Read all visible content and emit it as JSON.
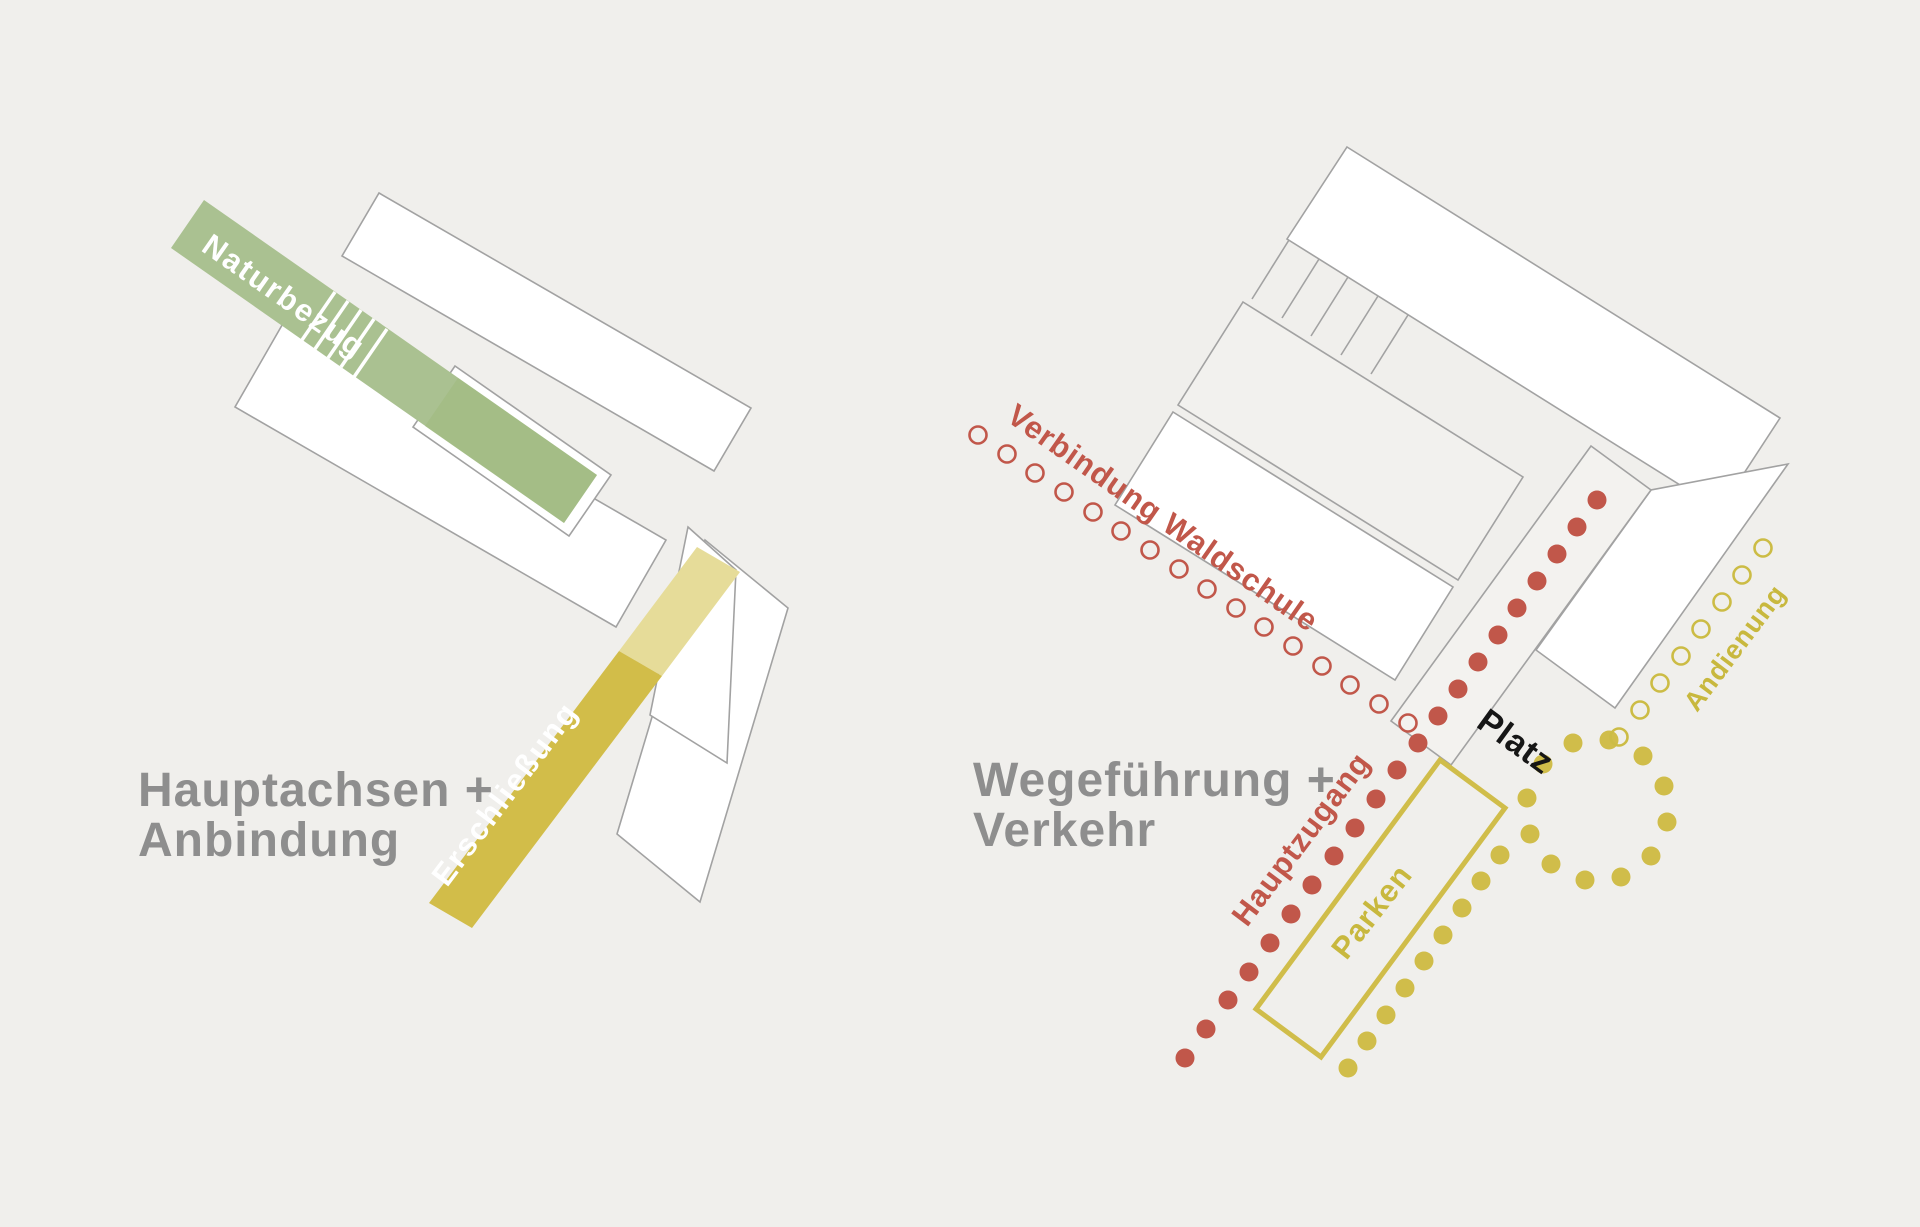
{
  "canvas": {
    "width": 1920,
    "height": 1227,
    "background": "#f0efec"
  },
  "palette": {
    "building_fill": "#ffffff",
    "building_fill_light": "#f2f1ee",
    "building_stroke": "#a2a2a2",
    "green_band": "#aac191",
    "green_band_dark": "#9fb97e",
    "yellow_band": "#d2bd49",
    "yellow_band_light": "#e6dc99",
    "red": "#c1574a",
    "yellow_dot": "#d0bd4a",
    "yellow_text": "#c8b83e",
    "title_gray": "#8e8e8e",
    "platz_black": "#161616"
  },
  "left_diagram": {
    "title_line1": "Hauptachsen +",
    "title_line2": "Anbindung",
    "green_band_label": "Naturbezug",
    "yellow_band_label": "Erschließung"
  },
  "right_diagram": {
    "title_line1": "Wegeführung +",
    "title_line2": "Verkehr",
    "label_verbindung": "Verbindung Waldschule",
    "label_platz": "Platz",
    "label_hauptzugang": "Hauptzugang",
    "label_parken": "Parken",
    "label_andienung": "Andienung"
  },
  "chains": [
    {
      "id": "red-open-waldschule",
      "style": "open",
      "color": "#c1574a",
      "r": 8.5,
      "stroke_width": 2.6,
      "points": [
        [
          978,
          435
        ],
        [
          1007,
          454
        ],
        [
          1035,
          473
        ],
        [
          1064,
          492
        ],
        [
          1093,
          512
        ],
        [
          1121,
          531
        ],
        [
          1150,
          550
        ],
        [
          1179,
          569
        ],
        [
          1207,
          589
        ],
        [
          1236,
          608
        ],
        [
          1264,
          627
        ],
        [
          1293,
          646
        ],
        [
          1322,
          666
        ],
        [
          1350,
          685
        ],
        [
          1379,
          704
        ],
        [
          1408,
          723
        ]
      ]
    },
    {
      "id": "red-filled-platz-axis",
      "style": "filled",
      "color": "#c1574a",
      "r": 9.5,
      "points": [
        [
          1597,
          500
        ],
        [
          1577,
          527
        ],
        [
          1557,
          554
        ],
        [
          1537,
          581
        ],
        [
          1517,
          608
        ],
        [
          1498,
          635
        ],
        [
          1478,
          662
        ],
        [
          1458,
          689
        ],
        [
          1438,
          716
        ],
        [
          1418,
          743
        ]
      ]
    },
    {
      "id": "red-filled-hauptzugang",
      "style": "filled",
      "color": "#c1574a",
      "r": 9.5,
      "points": [
        [
          1397,
          770
        ],
        [
          1376,
          799
        ],
        [
          1355,
          828
        ],
        [
          1334,
          856
        ],
        [
          1312,
          885
        ],
        [
          1291,
          914
        ],
        [
          1270,
          943
        ],
        [
          1249,
          972
        ],
        [
          1228,
          1000
        ],
        [
          1206,
          1029
        ],
        [
          1185,
          1058
        ]
      ]
    },
    {
      "id": "yellow-filled-parken-edge",
      "style": "filled",
      "color": "#d0bd4a",
      "r": 9.5,
      "points": [
        [
          1348,
          1068
        ],
        [
          1367,
          1041
        ],
        [
          1386,
          1015
        ],
        [
          1405,
          988
        ],
        [
          1424,
          961
        ],
        [
          1443,
          935
        ],
        [
          1462,
          908
        ],
        [
          1481,
          881
        ],
        [
          1500,
          855
        ]
      ]
    },
    {
      "id": "yellow-filled-loop",
      "style": "filled",
      "color": "#d0bd4a",
      "r": 9.5,
      "points": [
        [
          1530,
          834
        ],
        [
          1551,
          864
        ],
        [
          1585,
          880
        ],
        [
          1621,
          877
        ],
        [
          1651,
          856
        ],
        [
          1667,
          822
        ],
        [
          1664,
          786
        ],
        [
          1643,
          756
        ],
        [
          1609,
          740
        ],
        [
          1573,
          743
        ],
        [
          1543,
          764
        ],
        [
          1527,
          798
        ]
      ]
    },
    {
      "id": "yellow-open-andienung",
      "style": "open",
      "color": "#ccbc45",
      "r": 8.5,
      "stroke_width": 2.6,
      "points": [
        [
          1763,
          548
        ],
        [
          1742,
          575
        ],
        [
          1722,
          602
        ],
        [
          1701,
          629
        ],
        [
          1681,
          656
        ],
        [
          1660,
          683
        ],
        [
          1640,
          710
        ],
        [
          1619,
          737
        ]
      ]
    }
  ]
}
